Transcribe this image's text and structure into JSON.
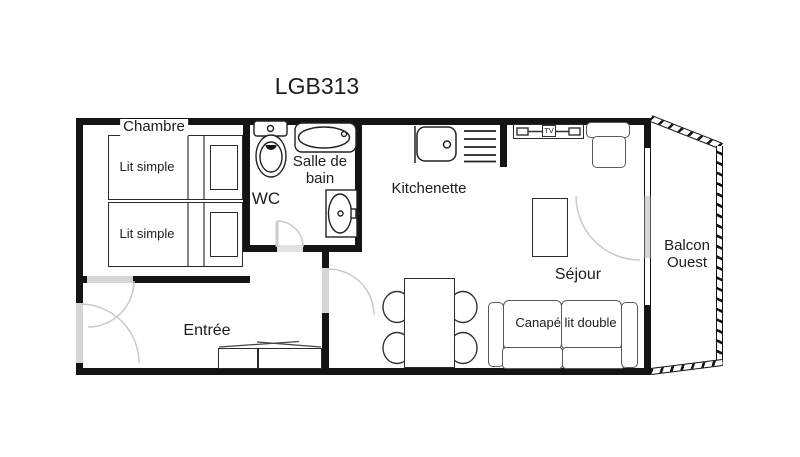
{
  "title": "LGB313",
  "rooms": {
    "chambre": "Chambre",
    "wc": "WC",
    "salle_de_bain": "Salle de bain",
    "kitchenette": "Kitchenette",
    "entree": "Entrée",
    "sejour": "Séjour",
    "balcon": "Balcon Ouest"
  },
  "furniture": {
    "lit1": "Lit simple",
    "lit2": "Lit simple",
    "canape": "Canapé lit double",
    "tv": "TV"
  },
  "colors": {
    "wall": "#141414",
    "door_panel": "#d6d6d6",
    "swing_arc": "#c9c9c9",
    "fixture_line": "#333333",
    "text": "#1c1c1c",
    "background": "#ffffff"
  }
}
